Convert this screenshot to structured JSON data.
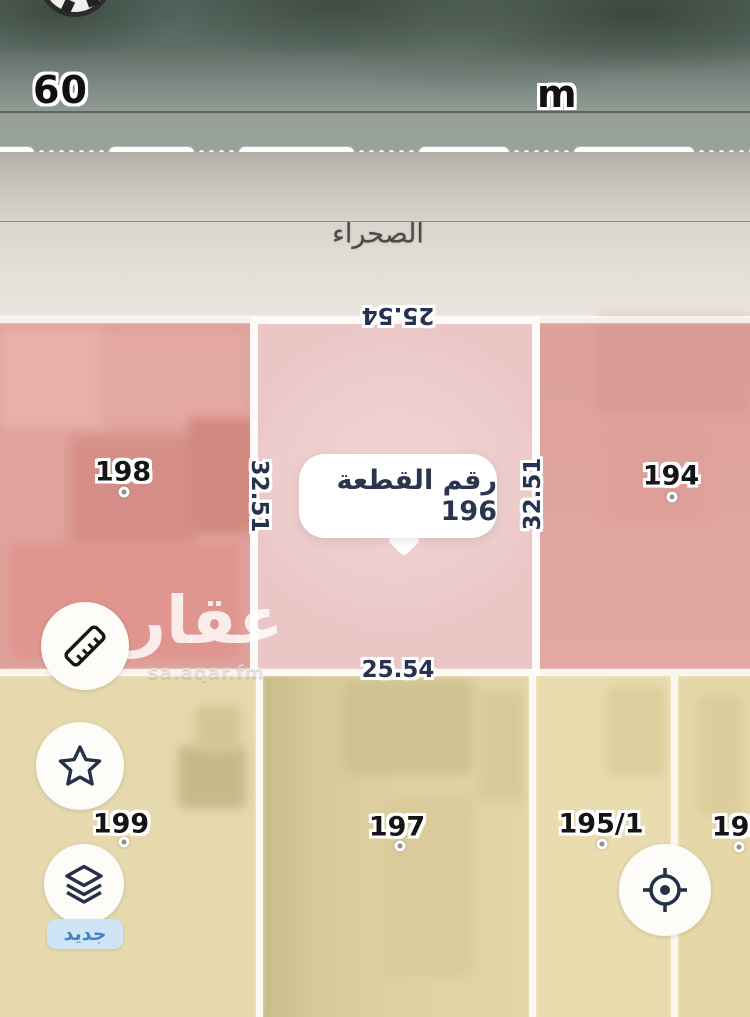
{
  "street": {
    "width_label": "60",
    "unit_label": "m",
    "name": "الصحراء"
  },
  "selected_plot": {
    "bubble_label": "رقم القطعة 196",
    "dim_top": "25.54",
    "dim_bottom": "25.54",
    "dim_left": "32.51",
    "dim_right": "32.51"
  },
  "plots": {
    "p198": {
      "label": "198"
    },
    "p194": {
      "label": "194"
    },
    "p199": {
      "label": "199"
    },
    "p197": {
      "label": "197"
    },
    "p195_1": {
      "label": "195/1"
    },
    "p195_2": {
      "label": "195/"
    }
  },
  "watermark": {
    "brand": "عقار",
    "domain": "sa.aqar.fm"
  },
  "controls": {
    "new_badge": "جديد",
    "icons": {
      "ruler": "ruler-icon",
      "star": "star-icon",
      "layers": "layers-icon",
      "locate": "locate-icon",
      "compass": "compass-icon"
    }
  },
  "colors": {
    "plot_pink": "#dfa29c",
    "plot_pink_selected": "#edcccb",
    "plot_yellow": "#e3d6a6",
    "parcel_border": "#fcfbf7",
    "dimension_text": "#27324f",
    "bubble_text": "#2b3550",
    "badge_bg": "#cfe4f4",
    "badge_text": "#3f86c7"
  }
}
